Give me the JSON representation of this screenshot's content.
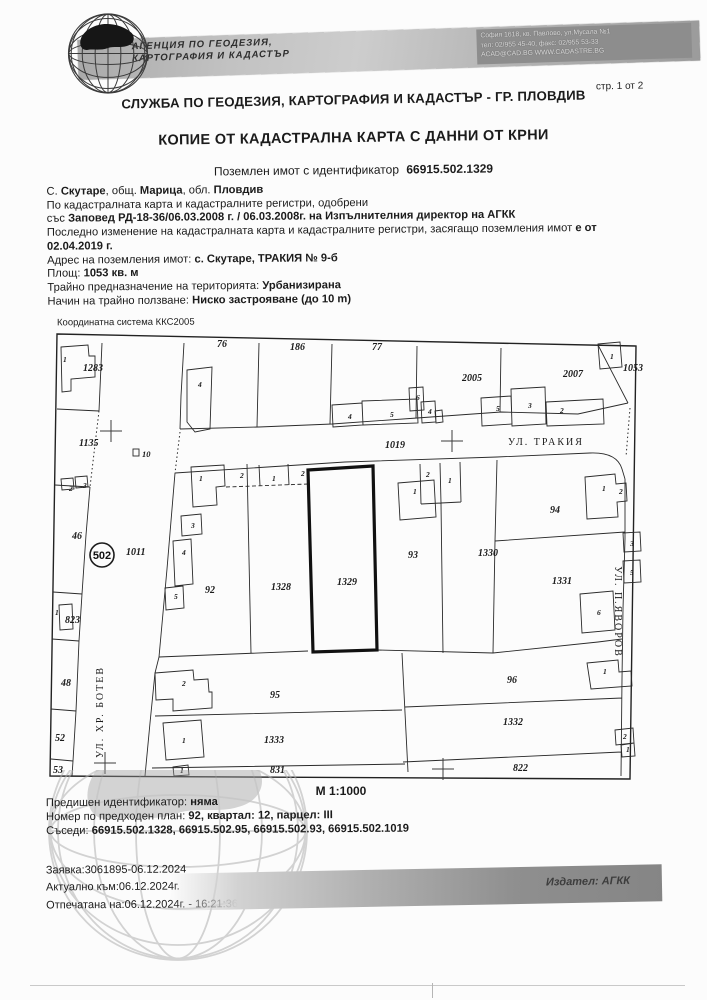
{
  "header": {
    "agency_line1": "АГЕНЦИЯ ПО ГЕОДЕЗИЯ,",
    "agency_line2": "КАРТОГРАФИЯ И КАДАСТЪР",
    "address_line1": "София 1618, кв. Павлово, ул.Мусала №1",
    "address_line2": "тел: 02/955 45-40, факс: 02/955 53-33",
    "address_line3": "ACAD@CAD.BG  WWW.CADASTRE.BG",
    "page_indicator": "стр. 1 от 2",
    "office_title": "СЛУЖБА ПО ГЕОДЕЗИЯ, КАРТОГРАФИЯ И КАДАСТЪР - ГР. ПЛОВДИВ"
  },
  "document": {
    "title": "КОПИЕ ОТ КАДАСТРАЛНА КАРТА С ДАННИ ОТ КРНИ",
    "subtitle_prefix": "Поземлен имот с  идентификатор",
    "identifier": "66915.502.1329",
    "info_lines": [
      [
        {
          "t": "С. ",
          "b": false
        },
        {
          "t": "Скутаре",
          "b": true
        },
        {
          "t": ", общ. ",
          "b": false
        },
        {
          "t": "Марица",
          "b": true
        },
        {
          "t": ", обл. ",
          "b": false
        },
        {
          "t": "Пловдив",
          "b": true
        }
      ],
      [
        {
          "t": "По кадастралната карта и кадастралните регистри, одобрени",
          "b": false
        }
      ],
      [
        {
          "t": "със ",
          "b": false
        },
        {
          "t": "Заповед РД-18-36/06.03.2008 г. / 06.03.2008г. на Изпълнителния директор на АГКК",
          "b": true
        }
      ],
      [
        {
          "t": "Последно изменение на кадастралната карта и кадастралните регистри, засягащо поземления имот ",
          "b": false
        },
        {
          "t": "е от",
          "b": true
        }
      ],
      [
        {
          "t": "02.04.2019 г.",
          "b": true
        }
      ],
      [
        {
          "t": "Адрес на поземления имот: ",
          "b": false
        },
        {
          "t": "с. Скутаре, ТРАКИЯ № 9-б",
          "b": true
        }
      ],
      [
        {
          "t": "Площ: ",
          "b": false
        },
        {
          "t": "1053 кв. м",
          "b": true
        }
      ],
      [
        {
          "t": "Трайно предназначение на територията: ",
          "b": false
        },
        {
          "t": "Урбанизирана",
          "b": true
        }
      ],
      [
        {
          "t": "Начин на трайно ползване: ",
          "b": false
        },
        {
          "t": "Ниско застрояване (до 10 m)",
          "b": true
        }
      ]
    ]
  },
  "map": {
    "coordinate_system": "Координатна система ККС2005",
    "scale": "М 1:1000",
    "zone": {
      "label": "502",
      "x": 57,
      "y": 226,
      "r": 12
    },
    "annotation": {
      "t": "10",
      "x": 97,
      "y": 128
    },
    "streets": [
      {
        "name": "УЛ. ТРАКИЯ",
        "x": 501,
        "y": 116,
        "rot": 0
      },
      {
        "name": "УЛ. ХР. БОТЕВ",
        "x": 58,
        "y": 383,
        "rot": -90
      },
      {
        "name": "УЛ. П.ЯВОРОВ",
        "x": 570,
        "y": 283,
        "rot": 90
      }
    ],
    "parcel_labels": [
      {
        "t": "1283",
        "x": 38,
        "y": 42
      },
      {
        "t": "1135",
        "x": 34,
        "y": 117
      },
      {
        "t": "46",
        "x": 27,
        "y": 210
      },
      {
        "t": "1011",
        "x": 81,
        "y": 226
      },
      {
        "t": "823",
        "x": 20,
        "y": 294
      },
      {
        "t": "48",
        "x": 16,
        "y": 357
      },
      {
        "t": "52",
        "x": 10,
        "y": 412
      },
      {
        "t": "53",
        "x": 8,
        "y": 444
      },
      {
        "t": "76",
        "x": 172,
        "y": 18
      },
      {
        "t": "186",
        "x": 245,
        "y": 21
      },
      {
        "t": "77",
        "x": 327,
        "y": 21
      },
      {
        "t": "2005",
        "x": 417,
        "y": 52
      },
      {
        "t": "2007",
        "x": 518,
        "y": 48
      },
      {
        "t": "1053",
        "x": 578,
        "y": 42
      },
      {
        "t": "1019",
        "x": 340,
        "y": 119
      },
      {
        "t": "92",
        "x": 160,
        "y": 264
      },
      {
        "t": "1328",
        "x": 226,
        "y": 261
      },
      {
        "t": "1329",
        "x": 292,
        "y": 256
      },
      {
        "t": "93",
        "x": 363,
        "y": 229
      },
      {
        "t": "1330",
        "x": 433,
        "y": 227
      },
      {
        "t": "94",
        "x": 505,
        "y": 184
      },
      {
        "t": "1331",
        "x": 507,
        "y": 255
      },
      {
        "t": "95",
        "x": 225,
        "y": 369
      },
      {
        "t": "96",
        "x": 462,
        "y": 354
      },
      {
        "t": "1333",
        "x": 219,
        "y": 414
      },
      {
        "t": "1332",
        "x": 458,
        "y": 396
      },
      {
        "t": "831",
        "x": 225,
        "y": 444
      },
      {
        "t": "822",
        "x": 468,
        "y": 442
      }
    ],
    "building_labels": [
      {
        "t": "1",
        "x": 18,
        "y": 33
      },
      {
        "t": "1",
        "x": 10,
        "y": 286
      },
      {
        "t": "2",
        "x": 24,
        "y": 162
      },
      {
        "t": "3",
        "x": 38,
        "y": 159
      },
      {
        "t": "4",
        "x": 153,
        "y": 58
      },
      {
        "t": "4",
        "x": 303,
        "y": 90
      },
      {
        "t": "5",
        "x": 345,
        "y": 88
      },
      {
        "t": "6",
        "x": 371,
        "y": 71
      },
      {
        "t": "4",
        "x": 383,
        "y": 85
      },
      {
        "t": "5",
        "x": 451,
        "y": 82
      },
      {
        "t": "3",
        "x": 483,
        "y": 79
      },
      {
        "t": "2",
        "x": 515,
        "y": 84
      },
      {
        "t": "1",
        "x": 565,
        "y": 30
      },
      {
        "t": "1",
        "x": 154,
        "y": 152
      },
      {
        "t": "2",
        "x": 195,
        "y": 149
      },
      {
        "t": "1",
        "x": 227,
        "y": 152
      },
      {
        "t": "2",
        "x": 256,
        "y": 147
      },
      {
        "t": "3",
        "x": 146,
        "y": 199
      },
      {
        "t": "4",
        "x": 137,
        "y": 226
      },
      {
        "t": "5",
        "x": 129,
        "y": 270
      },
      {
        "t": "2",
        "x": 381,
        "y": 148
      },
      {
        "t": "1",
        "x": 403,
        "y": 154
      },
      {
        "t": "1",
        "x": 368,
        "y": 165
      },
      {
        "t": "1",
        "x": 557,
        "y": 162
      },
      {
        "t": "2",
        "x": 574,
        "y": 165
      },
      {
        "t": "3",
        "x": 585,
        "y": 217
      },
      {
        "t": "5",
        "x": 585,
        "y": 246
      },
      {
        "t": "6",
        "x": 552,
        "y": 286
      },
      {
        "t": "2",
        "x": 137,
        "y": 357
      },
      {
        "t": "1",
        "x": 137,
        "y": 414
      },
      {
        "t": "1",
        "x": 135,
        "y": 444
      },
      {
        "t": "1",
        "x": 558,
        "y": 345
      },
      {
        "t": "2",
        "x": 578,
        "y": 410
      },
      {
        "t": "1",
        "x": 581,
        "y": 423
      }
    ],
    "crosses": [
      {
        "x": 66,
        "y": 102
      },
      {
        "x": 407,
        "y": 112
      },
      {
        "x": 60,
        "y": 434
      },
      {
        "x": 398,
        "y": 440
      }
    ]
  },
  "footer": {
    "info_lines": [
      [
        {
          "t": "Предишен идентификатор: ",
          "b": false
        },
        {
          "t": "няма",
          "b": true
        }
      ],
      [
        {
          "t": "Номер по предходен план: ",
          "b": false
        },
        {
          "t": "92, квартал: 12, парцел: III",
          "b": true
        }
      ],
      [
        {
          "t": "Съседи: ",
          "b": false
        },
        {
          "t": "66915.502.1328, 66915.502.95, 66915.502.93, 66915.502.1019",
          "b": true
        }
      ]
    ],
    "request_lines": [
      "Заявка:3061895-06.12.2024",
      "Актуално към:06.12.2024г.",
      "Отпечатана на:06.12.2024г. - 16:21:36"
    ],
    "issuer": "Издател: АГКК"
  }
}
